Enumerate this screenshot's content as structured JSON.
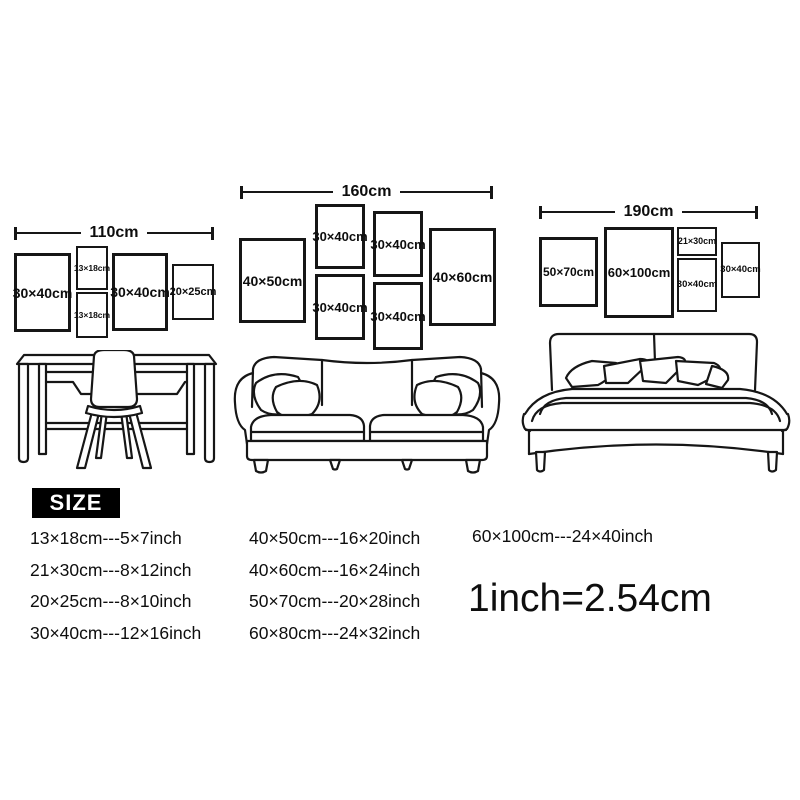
{
  "colors": {
    "background": "#ffffff",
    "line_art": "#161616",
    "size_heading_bg": "#000000",
    "size_heading_text": "#ffffff"
  },
  "scenes": [
    {
      "furniture": "desk-with-chair",
      "width_label": "110cm",
      "frames": [
        {
          "label": "30×40cm"
        },
        {
          "label": "13×18cm"
        },
        {
          "label": "13×18cm"
        },
        {
          "label": "30×40cm"
        },
        {
          "label": "20×25cm"
        }
      ]
    },
    {
      "furniture": "sofa",
      "width_label": "160cm",
      "frames": [
        {
          "label": "40×50cm"
        },
        {
          "label": "30×40cm"
        },
        {
          "label": "30×40cm"
        },
        {
          "label": "30×40cm"
        },
        {
          "label": "30×40cm"
        },
        {
          "label": "40×60cm"
        }
      ]
    },
    {
      "furniture": "bed",
      "width_label": "190cm",
      "frames": [
        {
          "label": "50×70cm"
        },
        {
          "label": "60×100cm"
        },
        {
          "label": "21×30cm"
        },
        {
          "label": "30×40cm"
        },
        {
          "label": "30×40cm"
        }
      ]
    }
  ],
  "size_section": {
    "heading": "SIZE",
    "columns": [
      [
        "13×18cm---5×7inch",
        "21×30cm---8×12inch",
        "20×25cm---8×10inch",
        "30×40cm---12×16inch"
      ],
      [
        "40×50cm---16×20inch",
        "40×60cm---16×24inch",
        "50×70cm---20×28inch",
        "60×80cm---24×32inch"
      ],
      [
        "60×100cm---24×40inch"
      ]
    ],
    "conversion": "1inch=2.54cm"
  }
}
